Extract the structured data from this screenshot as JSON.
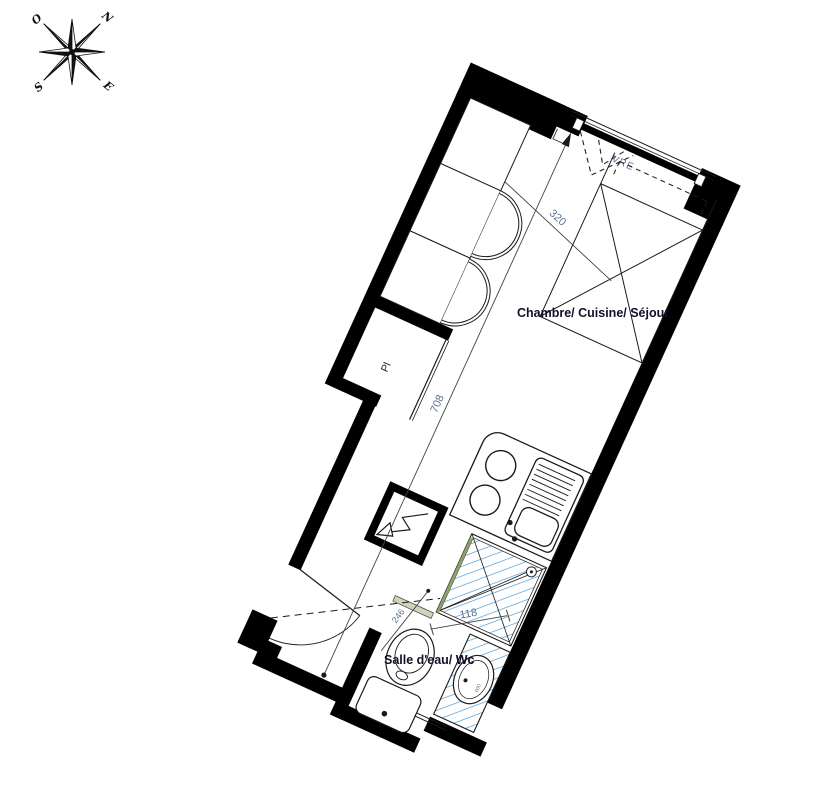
{
  "compass": {
    "north": "N",
    "south": "S",
    "east": "E",
    "west": "O"
  },
  "floorplan": {
    "rooms": {
      "main": "Chambre/ Cuisine/ Séjour",
      "bathroom": "Salle d'eau/ Wc",
      "closet": "Pl"
    },
    "window_label": "VRE",
    "dims": {
      "room_width": "320",
      "total_length": "708",
      "bath_width": "118",
      "bath_depth": "246"
    },
    "basin_size": "600",
    "colors": {
      "wall": "#000000",
      "fixture_line": "#1a1a1a",
      "hatch_blue": "#3d96d2",
      "dim_text": "#5e7191",
      "glass_green": "#8fa06b",
      "label_dark": "#10102a"
    }
  }
}
